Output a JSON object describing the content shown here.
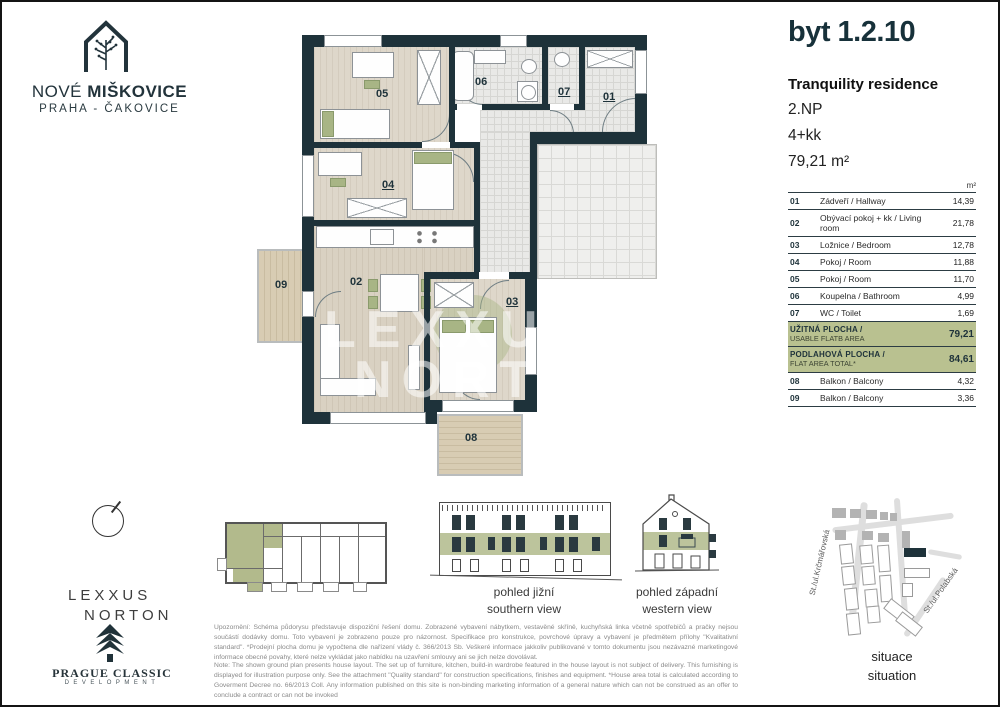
{
  "brand": {
    "nove": "NOVÉ",
    "miskovice": "MIŠKOVICE",
    "subtitle": "PRAHA - ČAKOVICE"
  },
  "unit": {
    "title": "byt 1.2.10",
    "project": "Tranquility residence",
    "floor": "2.NP",
    "layout": "4+kk",
    "area": "79,21 m²",
    "area_unit": "m²"
  },
  "rooms_table": {
    "rows": [
      {
        "code": "01",
        "name": "Zádveří / Hallway",
        "area": "14,39"
      },
      {
        "code": "02",
        "name": "Obývací pokoj + kk / Living room",
        "area": "21,78"
      },
      {
        "code": "03",
        "name": "Ložnice / Bedroom",
        "area": "12,78"
      },
      {
        "code": "04",
        "name": "Pokoj / Room",
        "area": "11,88"
      },
      {
        "code": "05",
        "name": "Pokoj / Room",
        "area": "11,70"
      },
      {
        "code": "06",
        "name": "Koupelna / Bathroom",
        "area": "4,99"
      },
      {
        "code": "07",
        "name": "WC / Toilet",
        "area": "1,69"
      }
    ],
    "summary": [
      {
        "label_cz": "UŽITNÁ PLOCHA /",
        "label_en": "USABLE FLATB AREA",
        "value": "79,21"
      },
      {
        "label_cz": "PODLAHOVÁ PLOCHA /",
        "label_en": "FLAT AREA TOTAL*",
        "value": "84,61"
      }
    ],
    "balconies": [
      {
        "code": "08",
        "name": "Balkon / Balcony",
        "area": "4,32"
      },
      {
        "code": "09",
        "name": "Balkon / Balcony",
        "area": "3,36"
      }
    ]
  },
  "plan": {
    "labels": {
      "r01": "01",
      "r02": "02",
      "r03": "03",
      "r04": "04",
      "r05": "05",
      "r06": "06",
      "r07": "07",
      "r08": "08",
      "r09": "09"
    }
  },
  "watermark": {
    "line1": "LEXXUS",
    "line2": "NORTON"
  },
  "logos": {
    "lexxus1": "LEXXUS",
    "lexxus2": "NORTON",
    "pc_name": "PRAGUE CLASSIC",
    "pc_sub": "DEVELOPMENT"
  },
  "views": {
    "south_cz": "pohled jižní",
    "south_en": "southern view",
    "west_cz": "pohled západní",
    "west_en": "western view"
  },
  "situation": {
    "caption_cz": "situace",
    "caption_en": "situation",
    "street_left": "St./ul.Krčmářovská",
    "street_right": "St./ul.Polabská"
  },
  "disclaimer": {
    "cz": "Upozornění: Schéma půdorysu představuje dispoziční řešení domu. Zobrazené vybavení nábytkem, vestavěné skříně, kuchyňská linka včetně spotřebičů a pračky nejsou součástí dodávky domu. Toto vybavení je zobrazeno pouze pro názornost. Specifikace pro konstrukce, povrchové úpravy a vybavení je předmětem přílohy \"Kvalitativní standard\". *Prodejní plocha domu je vypočtena dle nařízení vlády č. 366/2013 Sb. Veškeré informace jakkoliv publikované v tomto dokumentu jsou nezávazné marketingové informace obecné povahy, které nelze vykládat jako nabídku na uzavření smlouvy ani se jich nelze dovolávat.",
    "en": "Note: The shown ground plan presents house layout. The set up of furniture, kitchen, build-in wardrobe featured in the house layout is not subject of delivery. This furnishing is displayed for illustration purpose only. See the attachment \"Quality standard\" for construction specifications, finishes and equipment. *House area total is calculated according to Goverment Decree no. 66/2013 Coll. Any information published on this site is non-binding marketing information of a general nature which can not be construed as an offer to conclude a contract or can not be invoked"
  }
}
